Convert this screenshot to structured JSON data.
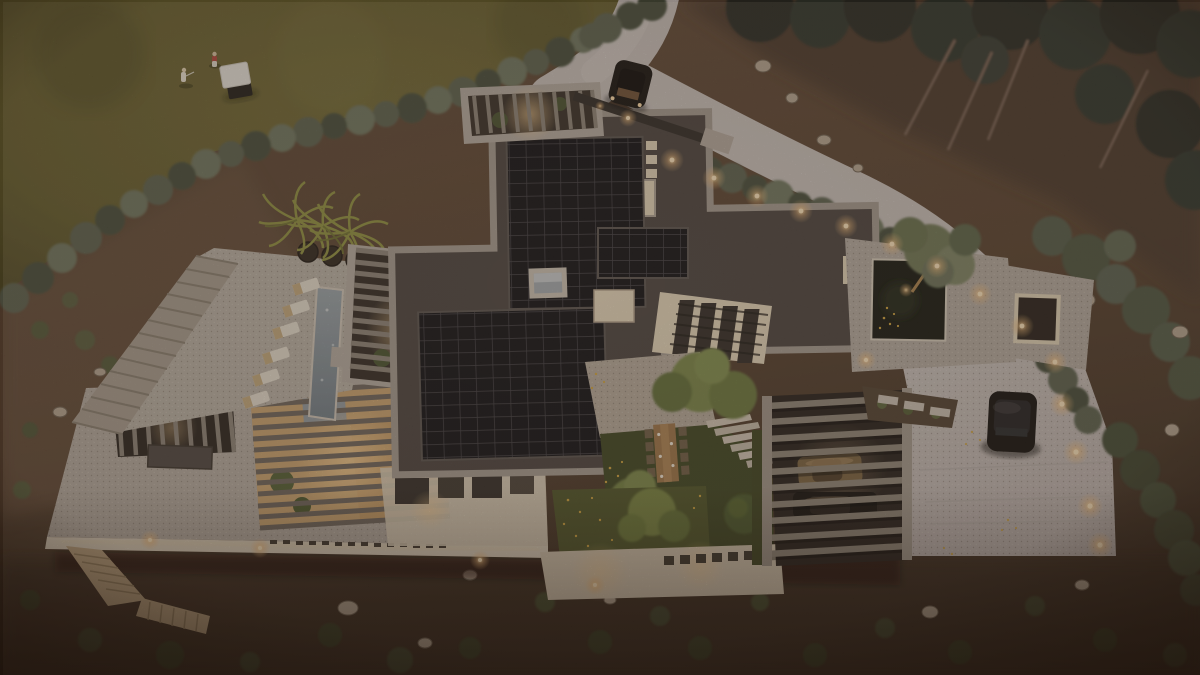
{
  "image": {
    "type": "3d-architectural-rendering",
    "view": "aerial-top-down",
    "time_of_day": "dusk",
    "description": "Bird's-eye dusk rendering of a modern flat-roofed hillside villa with rooftop solar arrays, lap-pool terrace with palms and loungers, glowing louvered courtyards, reflecting pond, slatted carport with two cars, curving driveway with a moving SUV and a parked SUV, bordered by a golf-course lawn with golfers and a cart, scrub hillside with boulders and a pine forest"
  },
  "palette": {
    "dirt": "#5a4535",
    "dirt_dark": "#3a2b20",
    "dirt_light": "#6b5340",
    "forest_floor": "#44352b",
    "lawn": "#6b6231",
    "lawn_dark": "#4f4a24",
    "shrub": "#59614f",
    "shrub_dark": "#434c3a",
    "shrub_light": "#6c755f",
    "pine": "#2c332a",
    "pine_dark": "#232820",
    "concrete": "#c9c2bf",
    "concrete_warm": "#d6d0cc",
    "slab": "#b4aba2",
    "slab_dark": "#958c82",
    "parapet": "#a39a91",
    "roof_dark": "#46403e",
    "roof_darker": "#393431",
    "panel": "#0b0c12",
    "panel_line": "#3c3b42",
    "beige": "#e2d5bc",
    "fascia": "#ddd2c0",
    "warm": "#ffd9a0",
    "warm_deep": "#e8a96a",
    "glow": "#ffe7c2",
    "water": "#8d99a2",
    "water_dark": "#6f7d88",
    "pond": "#11150f",
    "lounger": "#e5dfd2",
    "lounger_wood": "#c3a97e",
    "palm": "#8d9140",
    "palm_dark": "#6d7030",
    "planter": "#2c241d",
    "court_lawn": "#3a4220",
    "tree_green": "#768447",
    "tree_green_dark": "#5a6a36",
    "green_roof": "#4a5226",
    "wood": "#c59b66",
    "stair_wood": "#bfa782",
    "car_black": "#0e0d0c",
    "car_glass": "#23262b",
    "car_bronze": "#776140",
    "car_bronze_dark": "#4a3a26",
    "rock": "#b6a795",
    "rock_dark": "#8d7f6e",
    "steps": "#a79d91",
    "slat": "#8a8378",
    "slat_dark": "#6a635b",
    "flower_yellow": "#cfa43e",
    "gate_dark": "#2b2725"
  },
  "scene": {
    "golf_course": {
      "position": "top-left",
      "golfers": 2,
      "golf_cart": 1,
      "grass": "olive dusk lawn"
    },
    "driveway": {
      "entry": "top-center curve",
      "moving_vehicle": "dark SUV",
      "gate": "dark slatted gate at house entry",
      "apron": "large concrete court at right",
      "parked_vehicle": "black SUV",
      "hedge": "curved hedge with warm path lights"
    },
    "villa": {
      "roofs": {
        "material": "dark membrane with concrete parapets",
        "solar_arrays": 3,
        "skylight": 1,
        "vents": 3
      },
      "pergolas": {
        "count": 5,
        "lighting": "warm interior glow through louvers"
      },
      "pool_terrace": {
        "palms": 3,
        "planters": 3,
        "loungers": 6,
        "lap_pool": 1,
        "stair_band": "stone steps on left edge"
      },
      "entry_courtyard": {
        "dining_table": 1,
        "chairs": 8,
        "stone_steps": 6,
        "trees": 3,
        "round_shrub": 1,
        "lawn": "dark green with yellow wildflowers"
      },
      "reflecting_pond": {
        "sculptural_olive_tree": 1,
        "canopy_with_cutout": 1
      },
      "green_roof": {
        "trees": 1,
        "wildflowers": "yellow"
      },
      "carport": {
        "slatted_roof": true,
        "cars": [
          "bronze sports car",
          "dark SUV"
        ]
      },
      "hillside_stair": "timber zig-zag stair at bottom-left"
    },
    "landscape": {
      "hillside": "brown scrub slopes with boulders and winding dirt path",
      "forest": "dark pines with leaning trunks, top-right",
      "shrub_band": "sage shrubs separating lawn from property",
      "lights": "warm landscape lights along walls and hedges"
    }
  }
}
